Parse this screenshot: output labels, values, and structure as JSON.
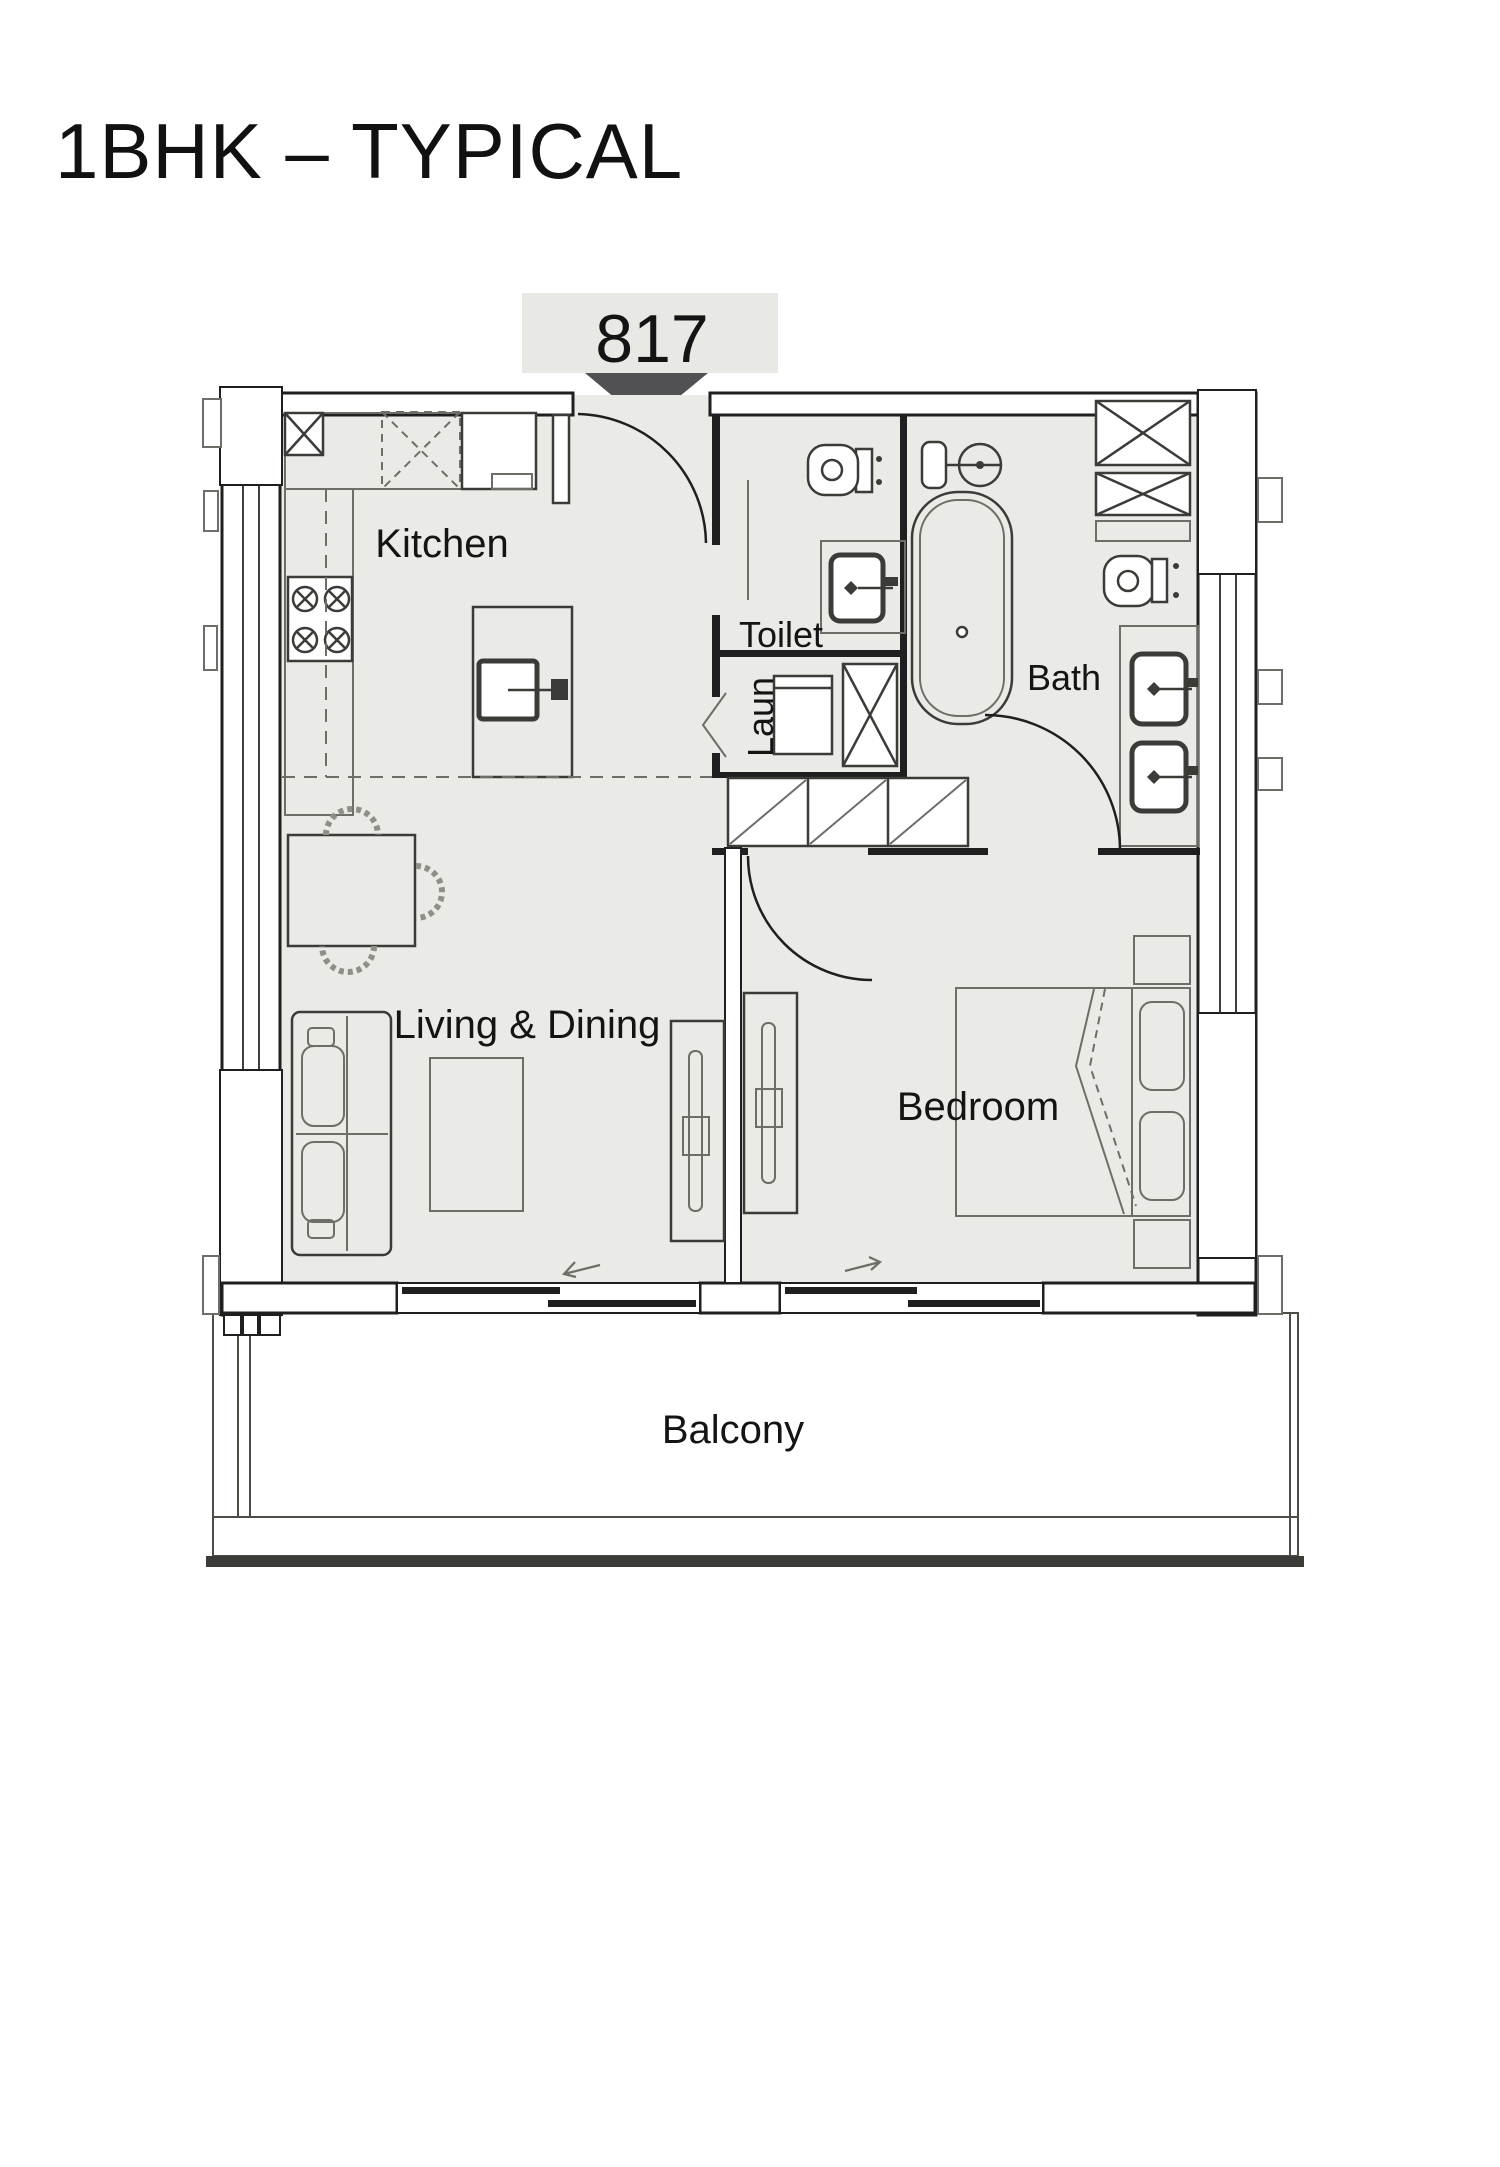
{
  "page": {
    "title": "1BHK – TYPICAL",
    "background": "#ffffff"
  },
  "unit": {
    "number": "817"
  },
  "rooms": {
    "kitchen": {
      "label": "Kitchen"
    },
    "toilet": {
      "label": "Toilet"
    },
    "laundry": {
      "label": "Laun"
    },
    "bath": {
      "label": "Bath"
    },
    "living_dining": {
      "label": "Living & Dining"
    },
    "bedroom": {
      "label": "Bedroom"
    },
    "balcony": {
      "label": "Balcony"
    }
  },
  "colors": {
    "floor": "#eaeae7",
    "wall_line": "#1f1f1f",
    "wall_fill": "#ffffff",
    "column": "#59595b",
    "balcony": "#ccd3c2",
    "balcony_edge": "#3b3b37",
    "label_box": "#e8e8e5",
    "entry_marker": "#515153",
    "text": "#141414",
    "fixture": "#3b3b38"
  }
}
